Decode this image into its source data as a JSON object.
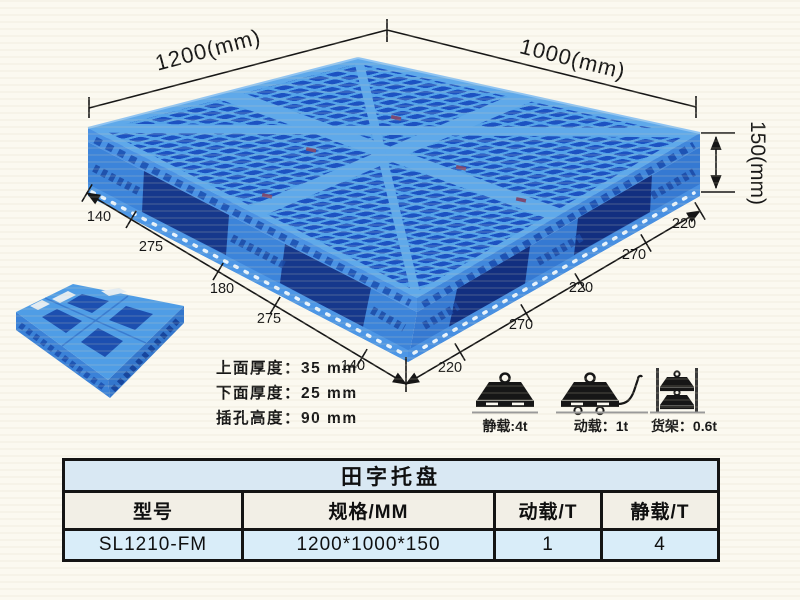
{
  "figure": {
    "dim_width": "1200(mm)",
    "dim_depth": "1000(mm)",
    "dim_height": "150(mm)",
    "left_chain": [
      "140",
      "275",
      "180",
      "275",
      "140"
    ],
    "right_chain": [
      "220",
      "270",
      "220",
      "270",
      "220"
    ],
    "notes": [
      "上面厚度：35 mm",
      "下面厚度：25 mm",
      "插孔高度：90 mm"
    ],
    "loads": [
      {
        "icon": "static-load-icon",
        "label": "静载:4t"
      },
      {
        "icon": "dynamic-load-icon",
        "label": "动载：1t"
      },
      {
        "icon": "rack-load-icon",
        "label": "货架：0.6t"
      }
    ]
  },
  "table": {
    "title": "田字托盘",
    "headers": [
      "型号",
      "规格/MM",
      "动载/T",
      "静载/T"
    ],
    "rows": [
      [
        "SL1210-FM",
        "1200*1000*150",
        "1",
        "4"
      ]
    ]
  },
  "colors": {
    "pallet_light": "#55a3e8",
    "pallet_hole": "#1c52c2",
    "pallet_side": "#3c84da",
    "table_title_bg": "#d9e8f3",
    "table_row_bg": "#d9edf9",
    "table_header_bg": "#f2efe6",
    "line": "#1a1a1a",
    "background": "#fbf9f0"
  }
}
